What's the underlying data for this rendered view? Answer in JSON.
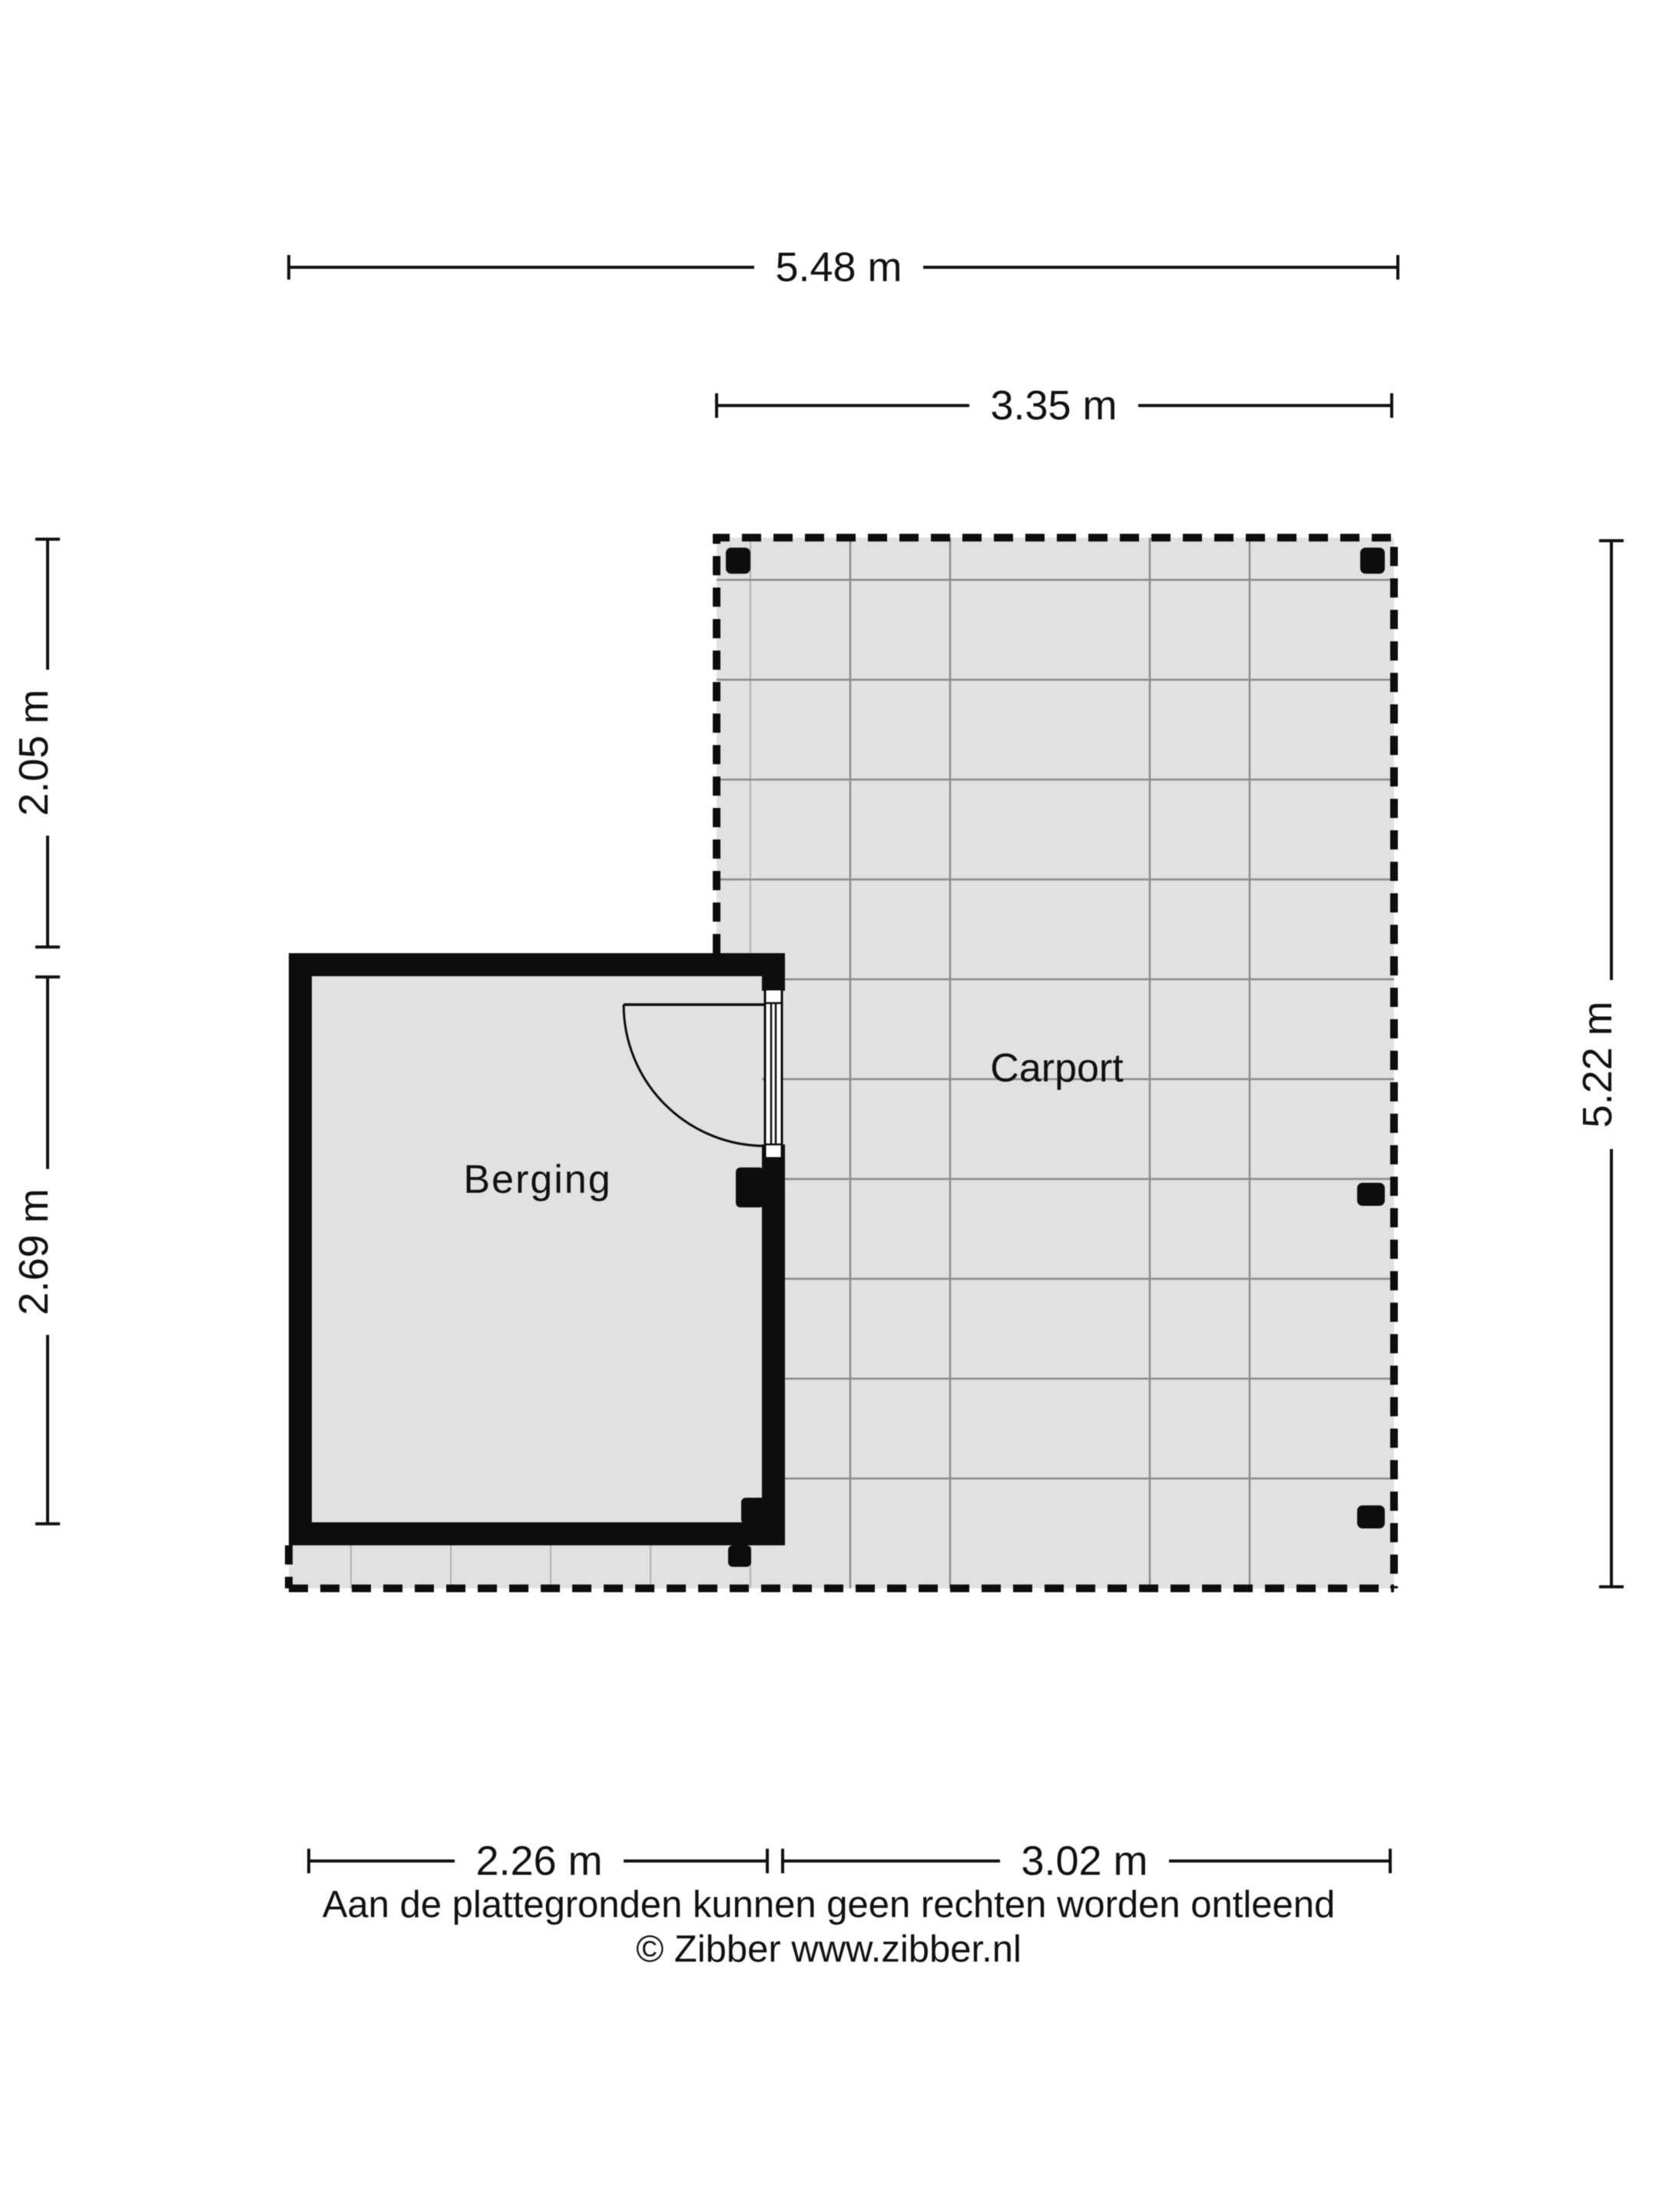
{
  "plan": {
    "rooms": {
      "berging": {
        "label": "Berging"
      },
      "carport": {
        "label": "Carport"
      }
    },
    "dimensions": {
      "top_total": "5.48 m",
      "top_carport": "3.35 m",
      "left_upper": "2.05 m",
      "left_lower": "2.69 m",
      "right_full": "5.22 m",
      "bottom_left": "2.26 m",
      "bottom_right": "3.02 m"
    }
  },
  "footer": {
    "disclaimer": "Aan de plattegronden kunnen geen rechten worden ontleend",
    "credit": "© Zibber www.zibber.nl"
  },
  "colors": {
    "background": "#ffffff",
    "floor": "#e1e1e1",
    "wall": "#0d0d0d",
    "grid_line": "#8a8a8a",
    "dimension_line": "#111111",
    "text": "#111111"
  }
}
